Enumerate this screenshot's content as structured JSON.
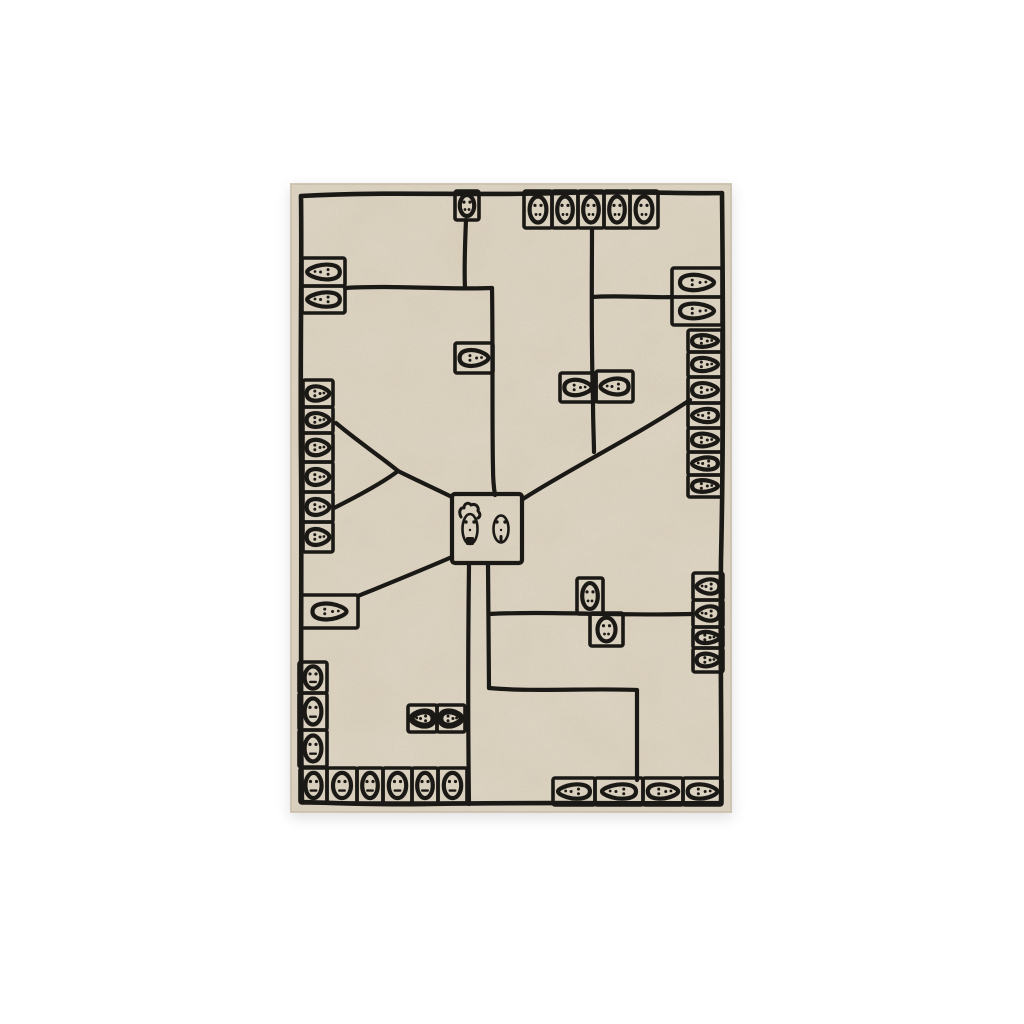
{
  "image": {
    "kind": "product-photo-of-rug",
    "description": "Cream rug with naive black line-art: boxed faces around borders connected by hand-drawn lines, two portrait faces in a central box",
    "background_color": "#ffffff",
    "colors": {
      "fabric_base": "#e2dacb",
      "fabric_grain": "#bfb29a",
      "fabric_blotch": "#cdbfa8",
      "fabric_edge": "#cfc6b5",
      "ink": "#1b1916",
      "shadow": "#000000"
    },
    "rug": {
      "fabric": {
        "x": 291,
        "y": 184,
        "w": 440,
        "h": 628
      },
      "border": {
        "x1": 301,
        "y1": 193,
        "x2": 722,
        "y2": 803
      },
      "lines": [
        {
          "id": "stem-top-single",
          "d": "M466,220 C465,244 464,266 465,288"
        },
        {
          "id": "h-upper-left",
          "d": "M345,288 C392,285 452,290 492,288"
        },
        {
          "id": "v-to-center",
          "d": "M492,288 C493,345 492,430 493,468 C493,480 494,489 495,495"
        },
        {
          "id": "v-top-row-stem",
          "d": "M592,229 C592,278 591,335 593,402 C593,424 594,441 594,452"
        },
        {
          "id": "h-upper-right",
          "d": "M592,297 C619,295 650,298 672,297"
        },
        {
          "id": "diag-main",
          "d": "M523,499 C568,470 634,437 690,400"
        },
        {
          "id": "diag-a",
          "d": "M336,423 C356,440 381,457 398,471"
        },
        {
          "id": "diag-b",
          "d": "M334,508 C356,497 381,484 398,471"
        },
        {
          "id": "diag-c",
          "d": "M398,471 C416,480 438,490 452,497"
        },
        {
          "id": "diag-d",
          "d": "M452,557 C422,570 385,585 358,596"
        },
        {
          "id": "v-center-left",
          "d": "M469,564 C468,642 468,732 469,804"
        },
        {
          "id": "v-center-right",
          "d": "M488,564 C488,610 489,656 489,688"
        },
        {
          "id": "h-lower-middle",
          "d": "M489,688 C532,692 592,688 637,690"
        },
        {
          "id": "v-lower-right",
          "d": "M637,690 C637,722 637,752 637,780"
        },
        {
          "id": "h-mid-right",
          "d": "M489,614 C548,611 622,616 693,614"
        }
      ],
      "face_boxes": [
        {
          "x": 455,
          "y": 191,
          "w": 24,
          "h": 29,
          "face": "v",
          "m": "dots"
        },
        {
          "x": 524,
          "y": 191,
          "w": 28,
          "h": 37,
          "face": "v",
          "m": "dots"
        },
        {
          "x": 552,
          "y": 191,
          "w": 26,
          "h": 37,
          "face": "v",
          "m": "dots"
        },
        {
          "x": 578,
          "y": 191,
          "w": 26,
          "h": 37,
          "face": "v",
          "m": "dots"
        },
        {
          "x": 604,
          "y": 191,
          "w": 26,
          "h": 37,
          "face": "v",
          "m": "dots"
        },
        {
          "x": 630,
          "y": 191,
          "w": 28,
          "h": 37,
          "face": "v",
          "m": "dots"
        },
        {
          "x": 302,
          "y": 258,
          "w": 43,
          "h": 28,
          "face": "hl"
        },
        {
          "x": 302,
          "y": 286,
          "w": 43,
          "h": 27,
          "face": "hl"
        },
        {
          "x": 303,
          "y": 380,
          "w": 30,
          "h": 27,
          "face": "hr"
        },
        {
          "x": 303,
          "y": 407,
          "w": 30,
          "h": 26,
          "face": "hr"
        },
        {
          "x": 303,
          "y": 433,
          "w": 30,
          "h": 29,
          "face": "hr"
        },
        {
          "x": 303,
          "y": 462,
          "w": 30,
          "h": 30,
          "face": "hr"
        },
        {
          "x": 303,
          "y": 492,
          "w": 30,
          "h": 30,
          "face": "hr"
        },
        {
          "x": 303,
          "y": 522,
          "w": 30,
          "h": 30,
          "face": "hr"
        },
        {
          "x": 301,
          "y": 595,
          "w": 57,
          "h": 33,
          "face": "hr"
        },
        {
          "x": 299,
          "y": 662,
          "w": 28,
          "h": 31,
          "face": "v",
          "m": "dash"
        },
        {
          "x": 299,
          "y": 693,
          "w": 28,
          "h": 37,
          "face": "v",
          "m": "dash"
        },
        {
          "x": 299,
          "y": 730,
          "w": 28,
          "h": 37,
          "face": "v",
          "m": "dash"
        },
        {
          "x": 300,
          "y": 768,
          "w": 27,
          "h": 35,
          "face": "v",
          "m": "dash"
        },
        {
          "x": 327,
          "y": 768,
          "w": 30,
          "h": 35,
          "face": "v",
          "m": "dash"
        },
        {
          "x": 357,
          "y": 768,
          "w": 26,
          "h": 35,
          "face": "v",
          "m": "dash"
        },
        {
          "x": 383,
          "y": 768,
          "w": 29,
          "h": 35,
          "face": "v",
          "m": "dash"
        },
        {
          "x": 412,
          "y": 768,
          "w": 26,
          "h": 35,
          "face": "v",
          "m": "dash"
        },
        {
          "x": 438,
          "y": 768,
          "w": 29,
          "h": 35,
          "face": "v",
          "m": "dash"
        },
        {
          "x": 672,
          "y": 268,
          "w": 50,
          "h": 29,
          "face": "hr"
        },
        {
          "x": 672,
          "y": 297,
          "w": 50,
          "h": 28,
          "face": "hr"
        },
        {
          "x": 688,
          "y": 330,
          "w": 34,
          "h": 22,
          "face": "hr"
        },
        {
          "x": 688,
          "y": 352,
          "w": 34,
          "h": 25,
          "face": "hr"
        },
        {
          "x": 688,
          "y": 377,
          "w": 34,
          "h": 26,
          "face": "hr"
        },
        {
          "x": 688,
          "y": 403,
          "w": 34,
          "h": 25,
          "face": "hl"
        },
        {
          "x": 688,
          "y": 428,
          "w": 34,
          "h": 24,
          "face": "hr"
        },
        {
          "x": 688,
          "y": 452,
          "w": 34,
          "h": 23,
          "face": "hl"
        },
        {
          "x": 688,
          "y": 475,
          "w": 34,
          "h": 22,
          "face": "hr"
        },
        {
          "x": 693,
          "y": 573,
          "w": 30,
          "h": 27,
          "face": "hl"
        },
        {
          "x": 693,
          "y": 600,
          "w": 30,
          "h": 27,
          "face": "hl"
        },
        {
          "x": 693,
          "y": 627,
          "w": 30,
          "h": 21,
          "face": "hr"
        },
        {
          "x": 693,
          "y": 648,
          "w": 30,
          "h": 24,
          "face": "hr"
        },
        {
          "x": 553,
          "y": 778,
          "w": 42,
          "h": 27,
          "face": "hl"
        },
        {
          "x": 595,
          "y": 778,
          "w": 48,
          "h": 27,
          "face": "hl"
        },
        {
          "x": 643,
          "y": 778,
          "w": 40,
          "h": 27,
          "face": "hr"
        },
        {
          "x": 683,
          "y": 778,
          "w": 39,
          "h": 27,
          "face": "hr"
        },
        {
          "x": 455,
          "y": 343,
          "w": 38,
          "h": 30,
          "face": "hr"
        },
        {
          "x": 560,
          "y": 373,
          "w": 36,
          "h": 29,
          "face": "hr"
        },
        {
          "x": 596,
          "y": 371,
          "w": 37,
          "h": 31,
          "face": "hl"
        },
        {
          "x": 577,
          "y": 578,
          "w": 26,
          "h": 36,
          "face": "v",
          "m": "dots"
        },
        {
          "x": 590,
          "y": 613,
          "w": 33,
          "h": 33,
          "face": "v",
          "m": "dots"
        },
        {
          "x": 408,
          "y": 705,
          "w": 29,
          "h": 27,
          "face": "hl",
          "thick": true
        },
        {
          "x": 437,
          "y": 705,
          "w": 28,
          "h": 27,
          "face": "hr",
          "thick": true
        }
      ],
      "portrait_box": {
        "x": 452,
        "y": 494,
        "w": 70,
        "h": 69,
        "left_face": {
          "cx": 470,
          "cy": 529,
          "rx": 7.5,
          "ry": 15,
          "hair": true,
          "mouth": "block"
        },
        "right_face": {
          "cx": 501,
          "cy": 529,
          "rx": 7.5,
          "ry": 13.5,
          "hair": false,
          "mouth": "bar"
        }
      }
    }
  }
}
